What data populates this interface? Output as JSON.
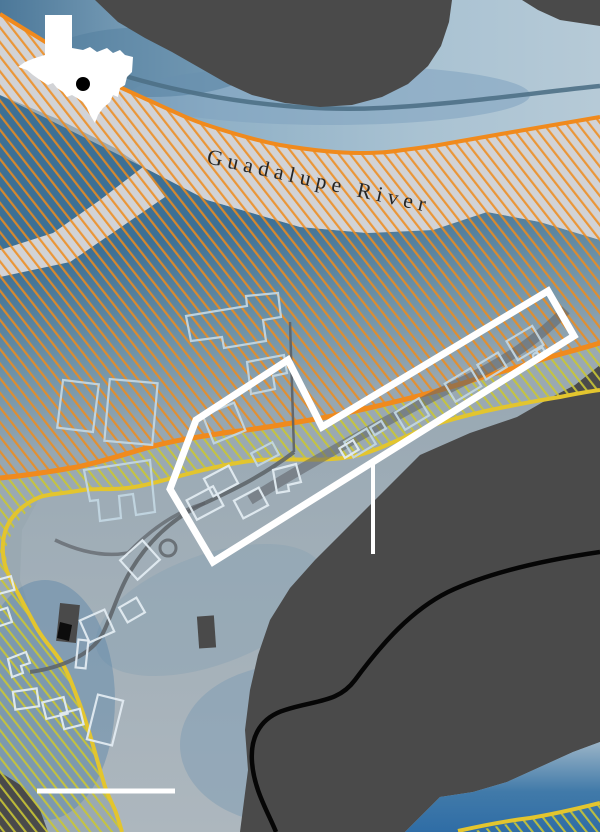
{
  "labels": {
    "river": "Guadalupe River"
  },
  "icons": {
    "inset": "texas-state-silhouette",
    "inset_marker": "location-dot"
  },
  "colors": {
    "terrain": "#4a4a4a",
    "flood_deep": "#3d7095",
    "flood_shallow": "#9fadb6",
    "water_light": "#a9c2d2",
    "water_channel": "#4e7086",
    "river_band": "#d2d3d6",
    "hatch_orange": "#ef8c1c",
    "line_orange": "#f08a1d",
    "hatch_yellow_green": "#c9c636",
    "line_yellow": "#e3c52e",
    "building_outline": "#c2d6e2",
    "building_outline_light": "#e2ebf1",
    "road_gray": "#5c6166",
    "road_black": "#060606",
    "annotation_white": "#ffffff",
    "label_text": "#262626",
    "inset_fill": "#ffffff",
    "inset_marker": "#000000"
  }
}
